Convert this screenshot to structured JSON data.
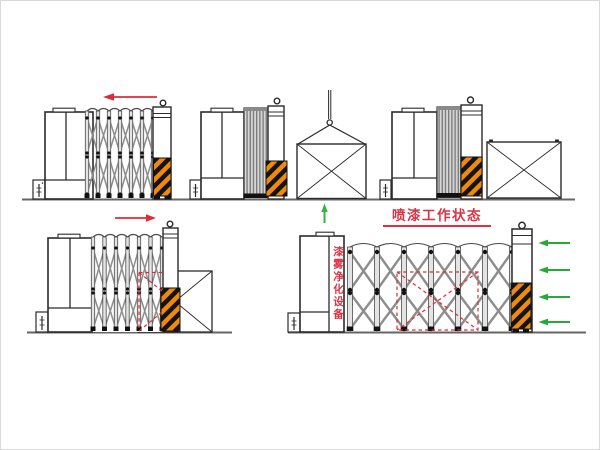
{
  "canvas": {
    "width": 600,
    "height": 450,
    "background": "#ffffff"
  },
  "labels": {
    "spray_state_title": "喷漆工作状态",
    "purifier_label": "漆雾净化设备"
  },
  "colors": {
    "annotation_red": "#d93344",
    "arrow_red": "#e02b36",
    "arrow_green": "#27a937",
    "hazard_orange": "#ef8a0e",
    "hazard_black": "#141414",
    "outline_black": "#2b2b2b",
    "lattice_gray": "#8d8d8d",
    "ground_gray": "#666666"
  },
  "icons": [
    "red-arrow-left-icon",
    "red-arrow-right-icon",
    "green-arrow-up-icon",
    "green-arrow-left-icon",
    "crane-hook-icon",
    "hook-icon",
    "hazard-stripe-block",
    "control-box",
    "workpiece-crate"
  ],
  "figures": [
    {
      "id": "top-left",
      "name": "booth-retracting"
    },
    {
      "id": "top-middle",
      "name": "booth-folded-workpiece-lifted-in"
    },
    {
      "id": "top-right",
      "name": "booth-folded-workpiece-placed"
    },
    {
      "id": "bottom-left",
      "name": "booth-extending-over-workpiece"
    },
    {
      "id": "bottom-right",
      "name": "booth-spray-working-state"
    }
  ]
}
